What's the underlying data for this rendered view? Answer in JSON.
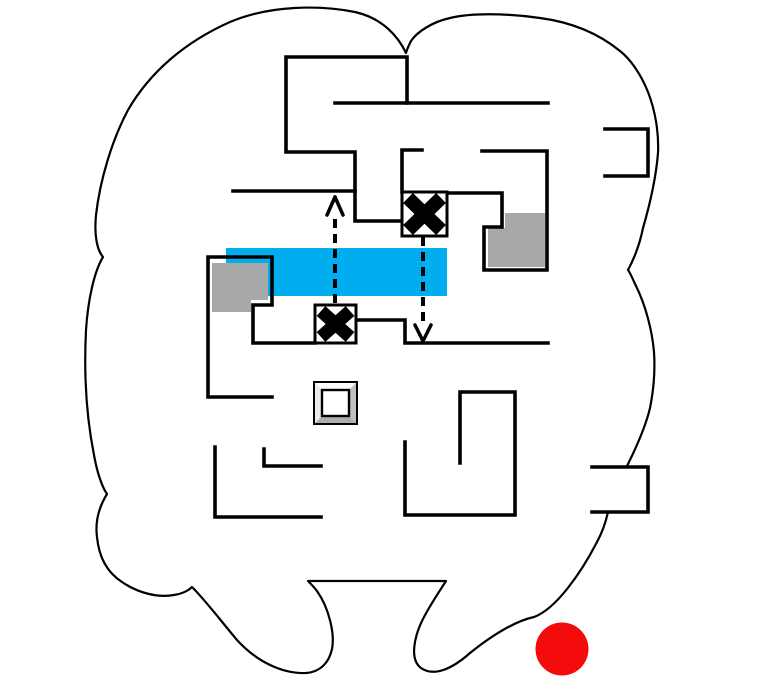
{
  "map": {
    "width": 765,
    "height": 680,
    "background": "#ffffff",
    "colors": {
      "outline": "#000000",
      "wall": "#000000",
      "water": "#00aeef",
      "gray_block": "#a8a8a8",
      "marker_red": "#f40b0b",
      "bevel_top": "#fcfcfc",
      "bevel_left": "#ececec",
      "bevel_right": "#bfbfbf",
      "bevel_bottom": "#aeaeae",
      "bevel_center": "#ffffff"
    },
    "outline": {
      "name": "cave-outline",
      "stroke_width": 2.2,
      "path": "M 406,53 C 398,36 382,18 355,12 C 320,5 270,5 230,22 C 185,42 150,72 128,110 C 112,140 100,180 96,215 C 94,235 97,250 103,257 C 94,272 88,300 86,330 C 84,370 86,415 94,455 C 97,472 102,487 107,494 C 99,507 95,522 97,537 C 99,558 108,573 122,582 C 138,593 158,598 174,595 C 181,594 188,591 192,587 C 206,601 221,621 237,640 C 257,662 283,674 306,673 C 320,672 329,663 332,649 C 335,634 329,608 317,591 C 314,587 311,584 308,581 L 446,581 C 441,589 432,602 424,617 C 413,638 410,660 421,668 C 434,677 452,669 470,653 C 491,636 515,621 534,617 C 556,609 581,573 597,542 C 603,531 606,521 608,512 C 614,496 621,481 627,466 C 637,446 646,425 650,408 C 654,388 655,367 654,352 C 652,329 645,304 636,286 C 633,280 631,274 628,270 C 635,257 640,243 643,228 C 650,204 656,178 658,153 C 659,132 655,110 648,92 C 640,72 629,58 620,51 C 598,33 570,22 540,18 C 505,13 470,13 450,18 C 432,22 417,32 411,41 C 409,45 407,49 406,53 Z"
    },
    "border_masks": [
      {
        "name": "border-notch-mask-bottom-right",
        "points": "592,467 648,467 648,512 592,512"
      }
    ],
    "water_bar": {
      "name": "blue-region",
      "x": 226,
      "y": 248,
      "w": 221,
      "h": 48
    },
    "gray_blocks": [
      {
        "name": "gray-block-left",
        "points": "212,263 268,263 268,300 251,300 251,312 212,312"
      },
      {
        "name": "gray-block-right",
        "points": "505,213 545,213 545,267 488,267 488,228 505,228"
      }
    ],
    "walls": {
      "name": "maze-walls",
      "stroke_width": 3.6,
      "polylines": [
        "335,103 548,103",
        "407,103 407,57 286,57 286,152 355,152 355,221 402,221",
        "233,191 355,191",
        "422,150 402,150 402,192",
        "447,193 502,193 502,227 484,227 484,270 547,270 547,151 482,151",
        "272,397 208,397 208,257 272,257 272,305 253,305 253,343 315,343",
        "356,320 405,320 405,343 548,343",
        "215,447 215,517 321,517",
        "264,449 264,466 321,466",
        "460,463 460,392 515,392 515,515 405,515 405,442",
        "605,129 648,129 648,176 605,176",
        "592,467 648,467 648,512 592,512"
      ]
    },
    "x_markers": [
      {
        "name": "x-marker-upper",
        "box": [
          402,
          192,
          45,
          44
        ],
        "cross_margin": 6,
        "cross_width": 14,
        "box_stroke": 3
      },
      {
        "name": "x-marker-lower",
        "box": [
          315,
          305,
          41,
          38
        ],
        "cross_margin": 6,
        "cross_width": 13,
        "box_stroke": 3
      }
    ],
    "dashed_arrows": [
      {
        "name": "teleport-arrow-up",
        "x": 335,
        "from_y": 303,
        "to_y": 216,
        "tip_y": 197,
        "arms": [
          [
            327,
            215
          ],
          [
            343,
            215
          ]
        ],
        "dash": "9 6",
        "line_width": 4,
        "head_width": 3.5
      },
      {
        "name": "teleport-arrow-down",
        "x": 423,
        "from_y": 237,
        "to_y": 324,
        "tip_y": 341,
        "arms": [
          [
            415,
            325
          ],
          [
            431,
            325
          ]
        ],
        "dash": "9 6",
        "line_width": 4,
        "head_width": 3.5
      }
    ],
    "bevel_block": {
      "name": "beveled-block-icon",
      "x": 314,
      "y": 382,
      "w": 43,
      "h": 42,
      "bevel": 8,
      "inner_stroke": 2.4,
      "outer_stroke": 2
    },
    "player_marker": {
      "name": "red-dot-marker",
      "cx": 562,
      "cy": 649,
      "r": 26.5
    }
  }
}
